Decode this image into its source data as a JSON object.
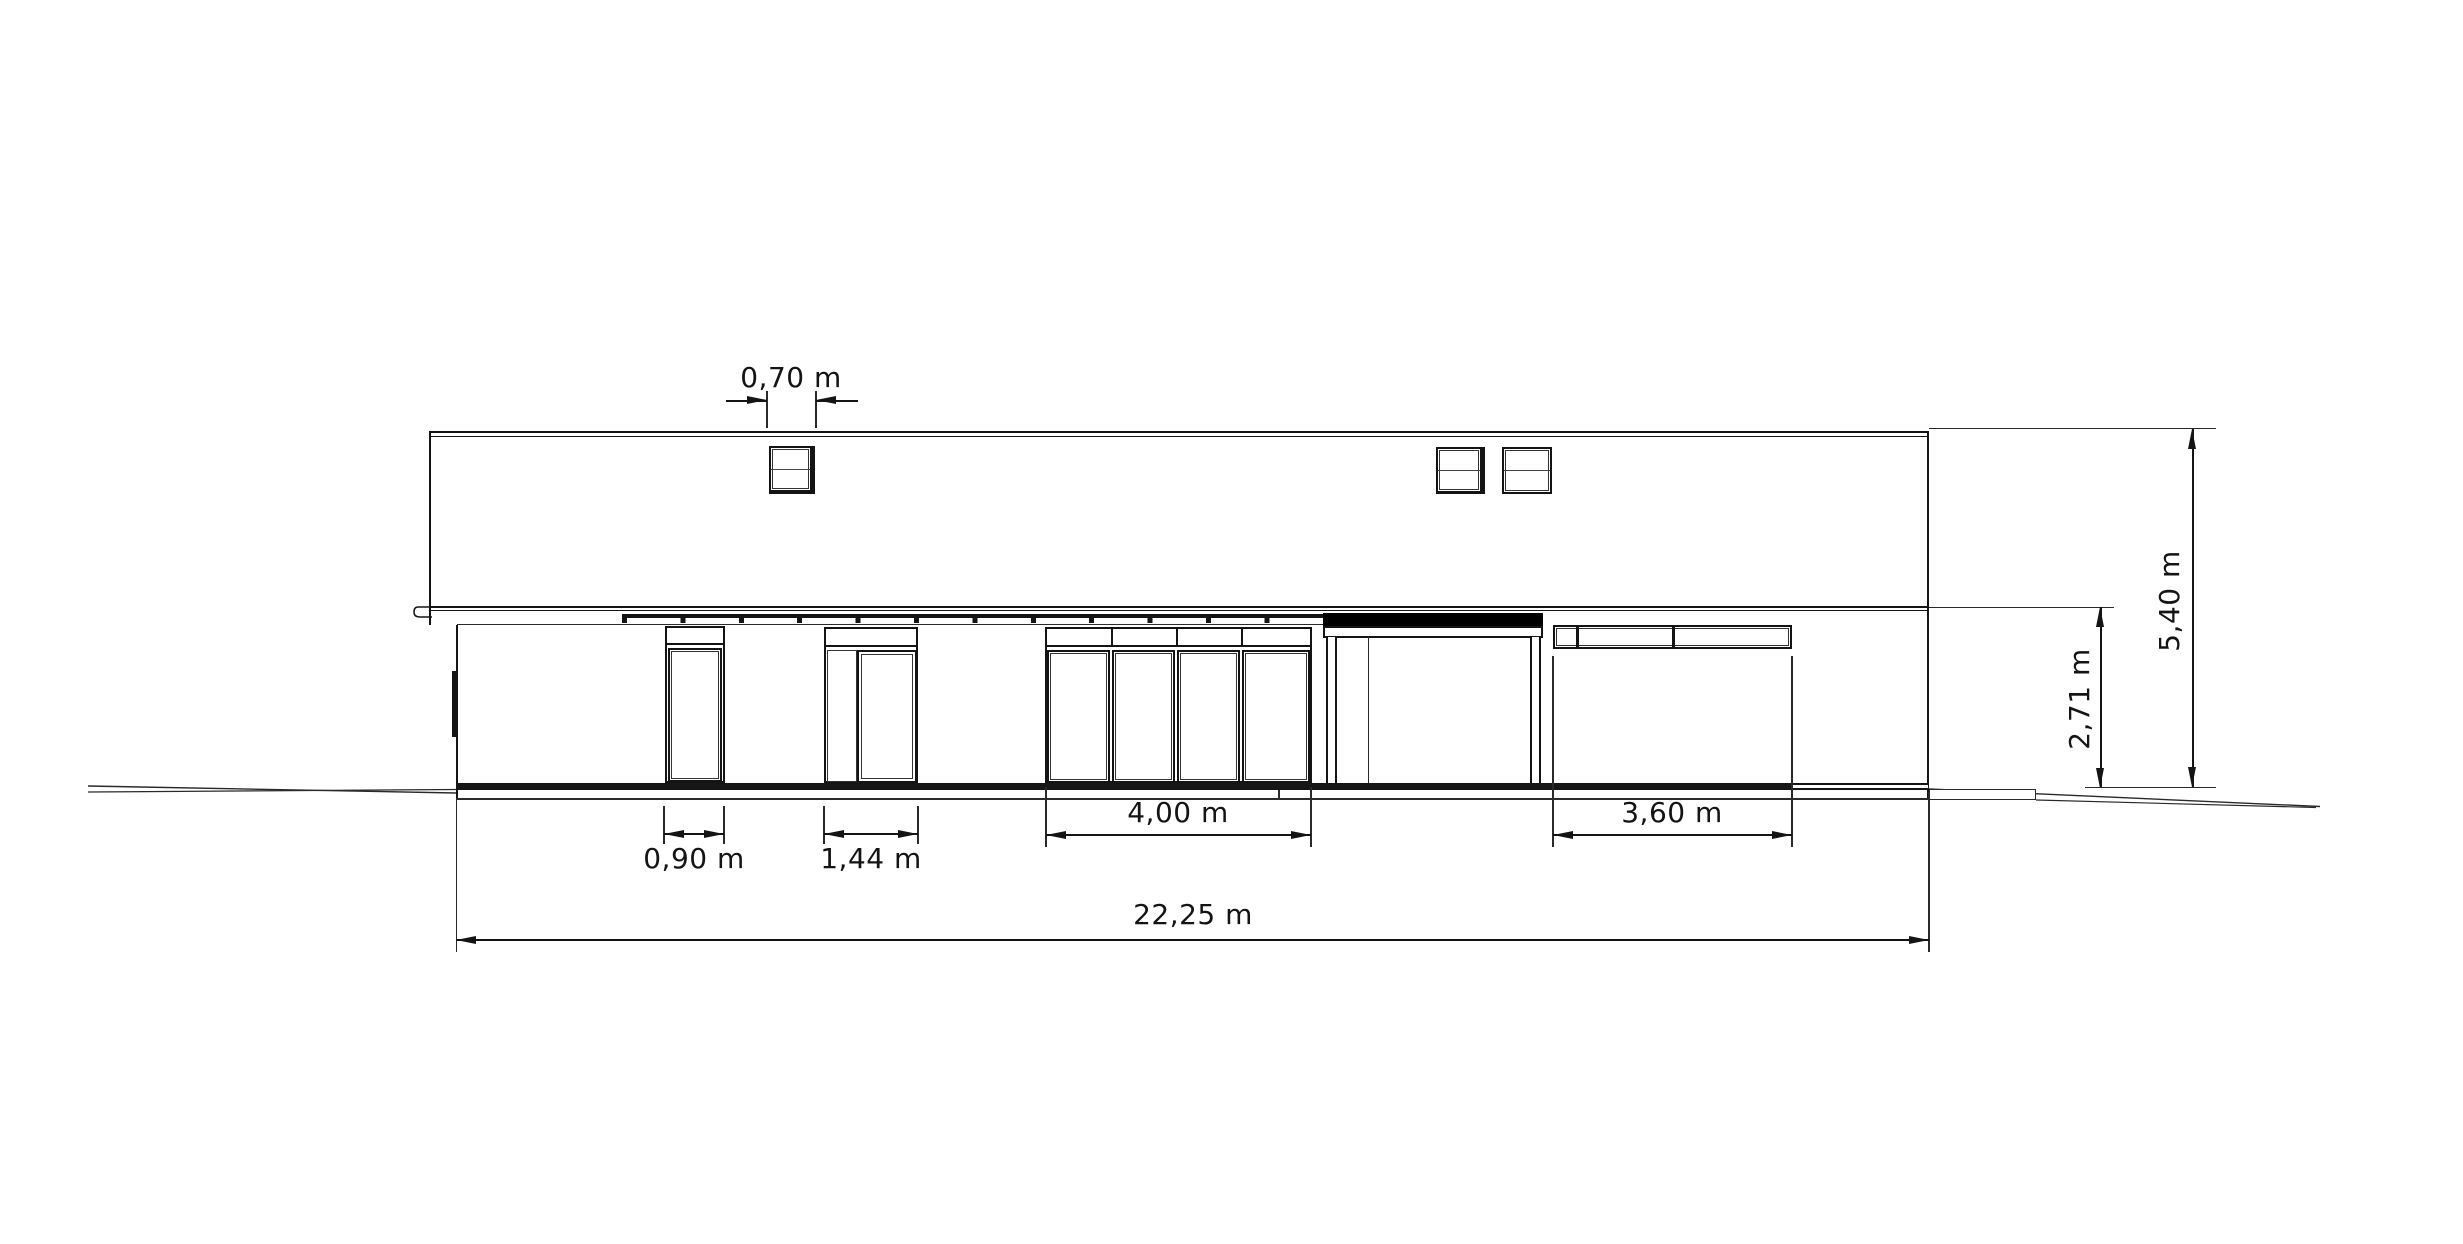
{
  "drawing": {
    "dimensions": {
      "roof_window_width": "0,70 m",
      "small_window_width": "0,90 m",
      "entrance_width": "1,44 m",
      "large_window_width": "4,00 m",
      "ribbon_window_width": "3,60 m",
      "total_width": "22,25 m",
      "eaves_height": "2,71 m",
      "total_height": "5,40 m"
    }
  }
}
